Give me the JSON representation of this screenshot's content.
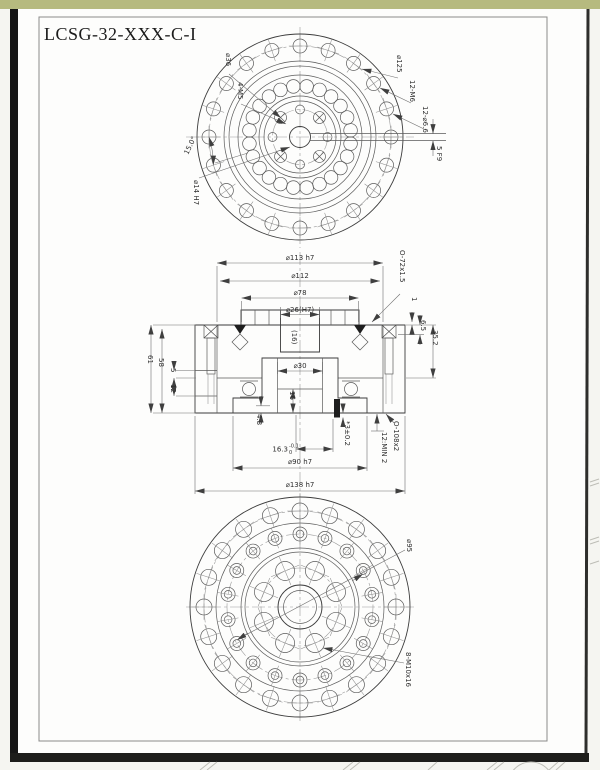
{
  "sheet": {
    "title": "LCSG-32-XXX-C-I"
  },
  "top_view": {
    "d36": "⌀36",
    "m5": "4-M5",
    "angle": "15.0°",
    "d14": "⌀14 H7",
    "d125": "⌀125",
    "m6": "12-M6",
    "d66": "12-⌀6.6",
    "key": "5 F9"
  },
  "section_view": {
    "d113": "⌀113 h7",
    "d112": "⌀112",
    "d78": "⌀78",
    "d26": "⌀26(H7)",
    "depth16": "(16)",
    "oring_top": "O-72x1.5",
    "h1": "1",
    "h65": "6.5",
    "h352": "35.2",
    "h61": "61",
    "h58": "58",
    "h5": "5",
    "h12": "12",
    "d30": "⌀30",
    "bore16": "16",
    "h48": "4.8",
    "w163_base": "16.3",
    "w163_sub": "0",
    "w163_sup": "-0.1",
    "pin": "*3±0.2",
    "oring_bot": "O-108x2",
    "min2": "12:MIN 2",
    "d90": "⌀90 h7",
    "d138": "⌀138 h7"
  },
  "bottom_view": {
    "d95": "⌀95",
    "m10": "8-M10x16"
  }
}
